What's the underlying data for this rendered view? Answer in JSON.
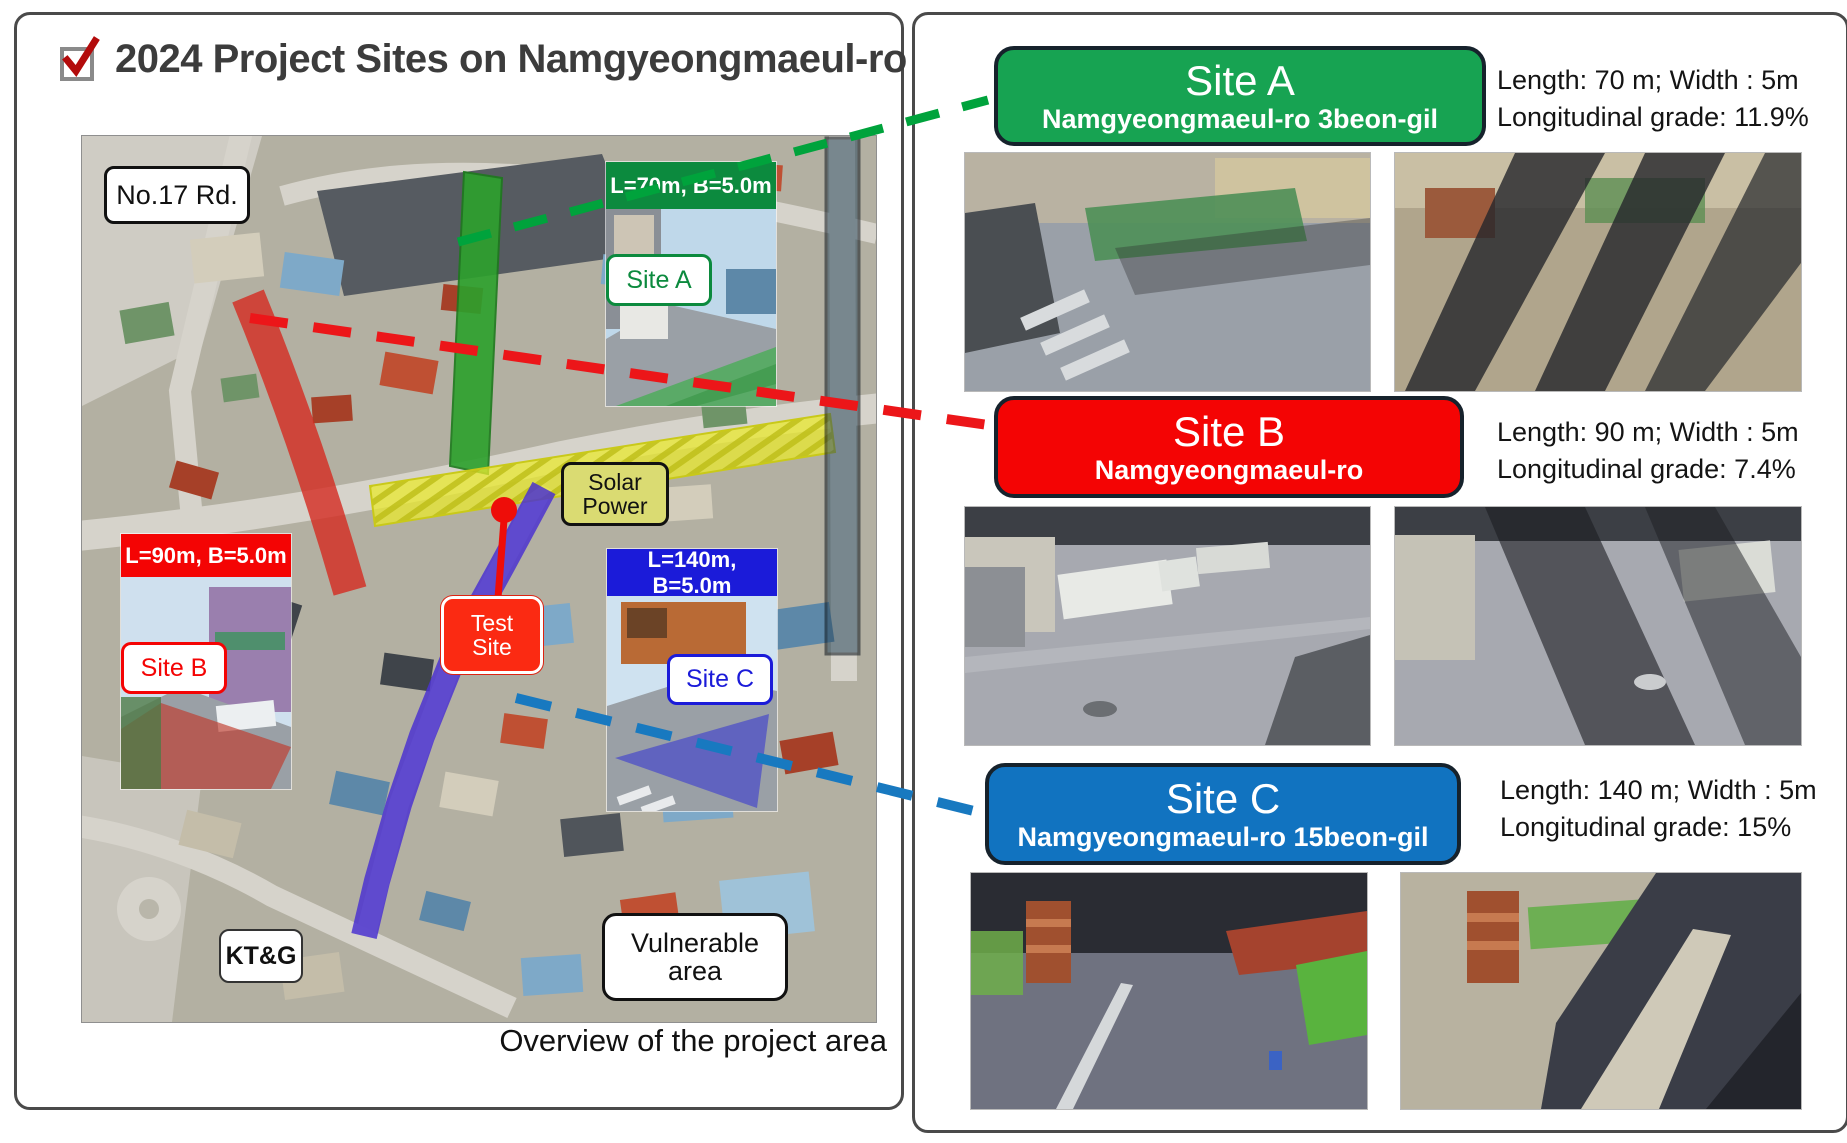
{
  "page": {
    "title": "2024 Project Sites on Namgyeongmaeul-ro",
    "overview_caption": "Overview of the project area"
  },
  "map": {
    "road_label": "No.17 Rd.",
    "solar_label_line1": "Solar",
    "solar_label_line2": "Power",
    "test_label_line1": "Test",
    "test_label_line2": "Site",
    "ktg_label": "KT&G",
    "vulnerable_line1": "Vulnerable",
    "vulnerable_line2": "area",
    "overlay_colors": {
      "site_a_road": "#2ca12c",
      "site_b_road": "#d42a20",
      "site_c_road": "#4b33d0",
      "solar_road": "#e9e92f",
      "study_bar": "#2c4a5e"
    },
    "connector_colors": {
      "site_a": "#00a33c",
      "site_b": "#ec1619",
      "site_c": "#1879c0"
    },
    "insets": [
      {
        "dimension": "L=70m, B=5.0m",
        "chip": "Site A",
        "color": "#0c8a3e"
      },
      {
        "dimension": "L=90m, B=5.0m",
        "chip": "Site B",
        "color": "#f40404"
      },
      {
        "dimension": "L=140m, B=5.0m",
        "chip": "Site C",
        "color": "#1b1bd9"
      }
    ]
  },
  "sites": [
    {
      "name": "Site A",
      "road": "Namgyeongmaeul-ro 3beon-gil",
      "length": "Length: 70 m; Width : 5m",
      "grade": "Longitudinal grade: 11.9%",
      "color": "#17a352"
    },
    {
      "name": "Site B",
      "road": "Namgyeongmaeul-ro",
      "length": "Length: 90 m; Width : 5m",
      "grade": "Longitudinal grade: 7.4%",
      "color": "#f40404"
    },
    {
      "name": "Site C",
      "road": "Namgyeongmaeul-ro 15beon-gil",
      "length": "Length: 140 m; Width : 5m",
      "grade": "Longitudinal grade: 15%",
      "color": "#1173c0"
    }
  ]
}
